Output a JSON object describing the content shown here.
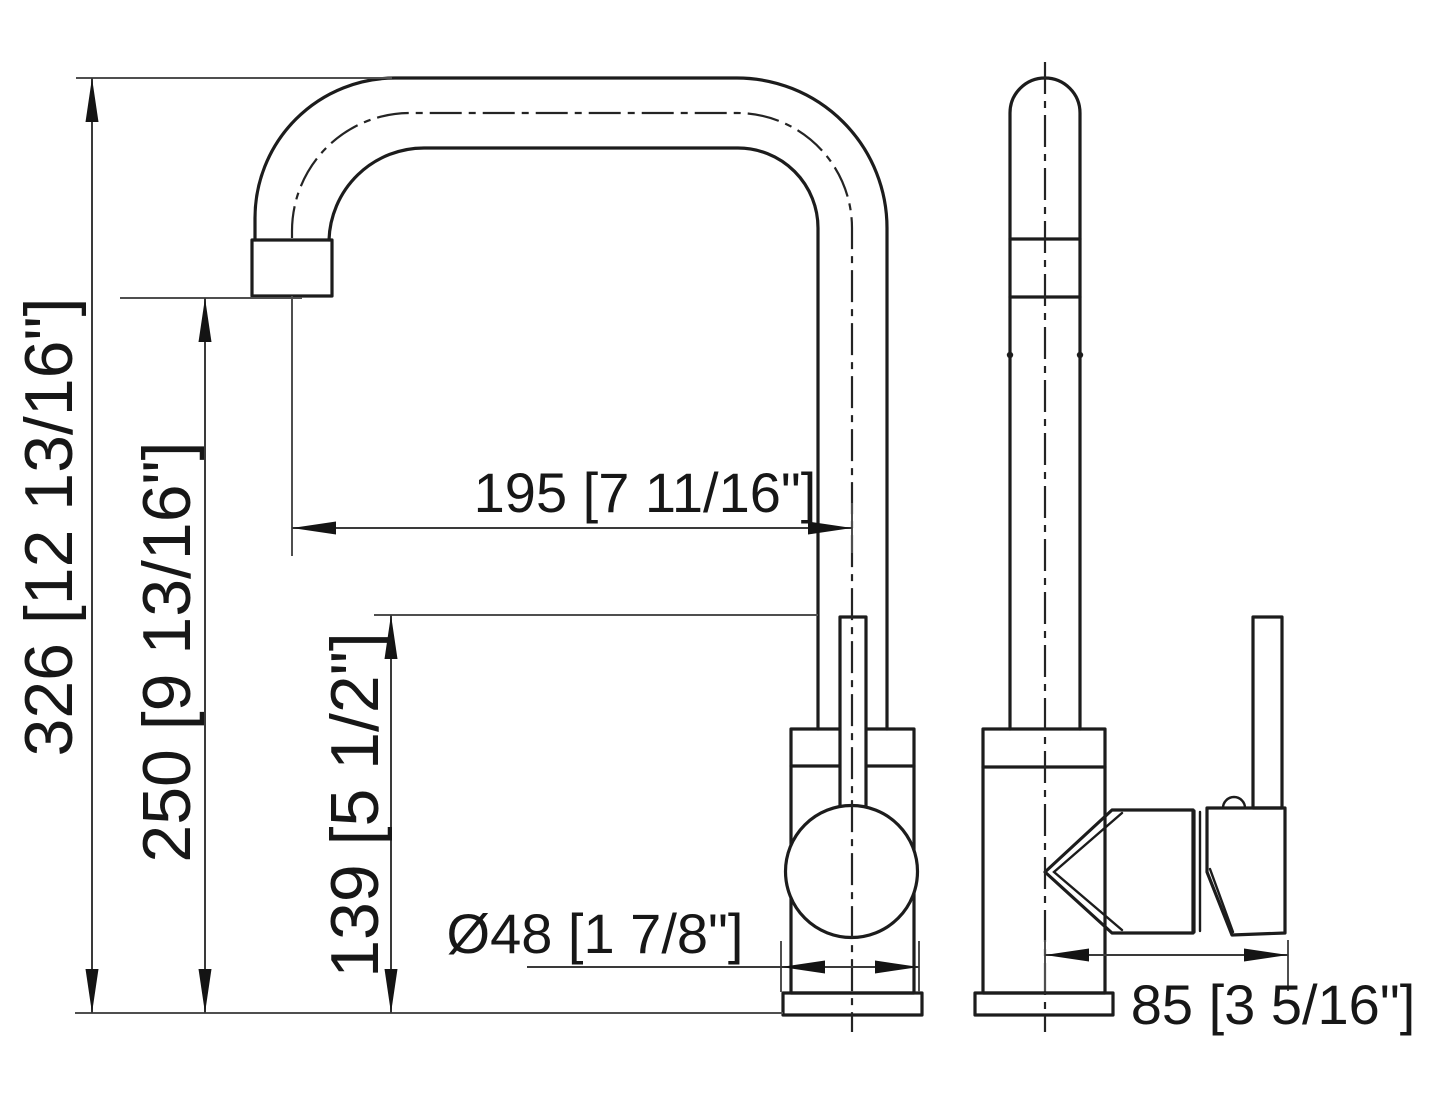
{
  "drawing": {
    "title": "faucet-dimension-drawing",
    "subject": "single-handle kitchen faucet, front and side orthographic views",
    "units": "millimeters [inches]",
    "dimensions": {
      "overall_height": "326 [12 13/16\"]",
      "spout_outlet_height": "250 [9 13/16\"]",
      "spout_reach": "195 [7 11/16\"]",
      "handle_top_height": "139 [5 1/2\"]",
      "base_diameter": "Ø48 [1 7/8\"]",
      "body_depth": "85 [3 5/16\"]"
    },
    "colors": {
      "background": "#ffffff",
      "object_line": "#1c1c1c",
      "dimension_line": "#3a3a3a",
      "extension_line": "#4f4f4f",
      "text": "#171717"
    }
  }
}
